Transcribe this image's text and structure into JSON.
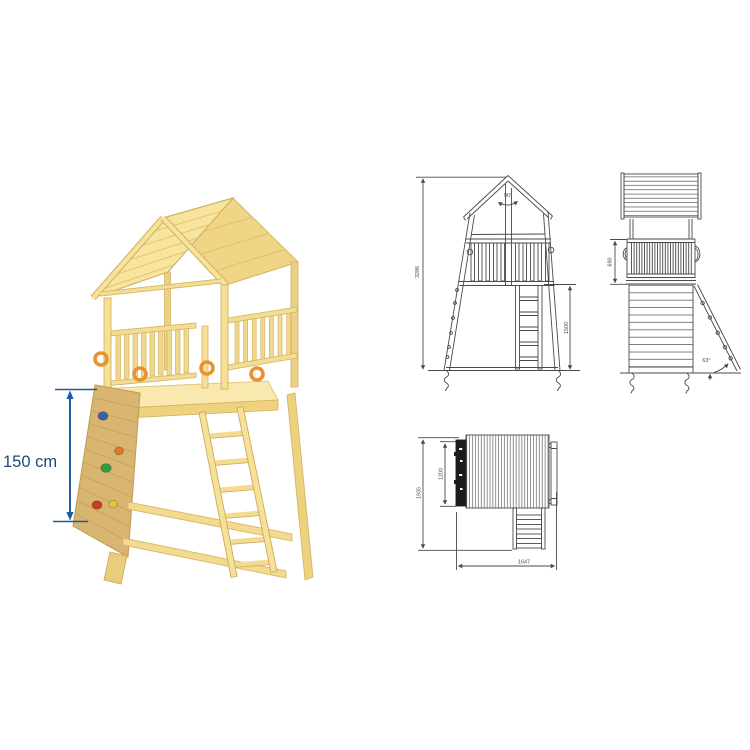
{
  "render": {
    "dimension_label": "150 cm",
    "colors": {
      "wood": "#f7e49d",
      "wood_light": "#f9e9ae",
      "wood_mid": "#efd585",
      "wood_shade": "#e9cd7a",
      "wood_edge": "#d5b464",
      "wall": "#d8b570",
      "wall_line": "#c39e55",
      "ring_orange": "#e8932d",
      "arrow_blue": "#1d5d9d",
      "label_blue": "#1a4a78"
    },
    "holds": [
      {
        "name": "hold-blue",
        "color": "#3c5ead"
      },
      {
        "name": "hold-orange",
        "color": "#e0762f"
      },
      {
        "name": "hold-green",
        "color": "#2f9e41"
      },
      {
        "name": "hold-red",
        "color": "#c93b22"
      },
      {
        "name": "hold-yellow",
        "color": "#e5c636"
      }
    ]
  },
  "drawings": {
    "stroke": "#4a4a4a",
    "front_view": {
      "roof_angle": "90°",
      "total_height": "3286",
      "platform_height": "1500"
    },
    "side_view": {
      "railing_height": "690",
      "ladder_angle": "63°"
    },
    "top_view": {
      "overall_depth": "1935",
      "platform_width": "1200",
      "overall_width": "1647"
    }
  }
}
